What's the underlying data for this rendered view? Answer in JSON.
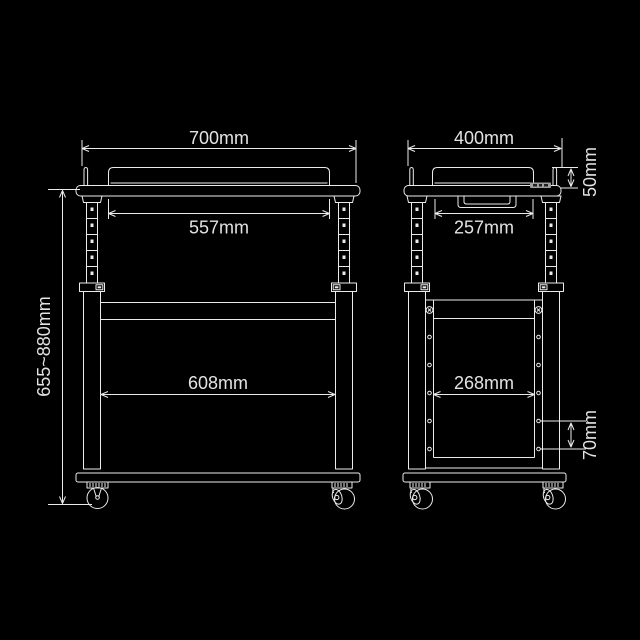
{
  "colors": {
    "background": "#000000",
    "line": "#ebebeb",
    "text": "#e3e3e3"
  },
  "front_view": {
    "top_width": "700mm",
    "rail_width": "557mm",
    "shelf_width": "608mm",
    "height_range": "655~880mm"
  },
  "side_view": {
    "top_depth": "400mm",
    "lip_height": "50mm",
    "rail_depth": "257mm",
    "shelf_depth": "268mm",
    "hole_spacing": "70mm"
  }
}
